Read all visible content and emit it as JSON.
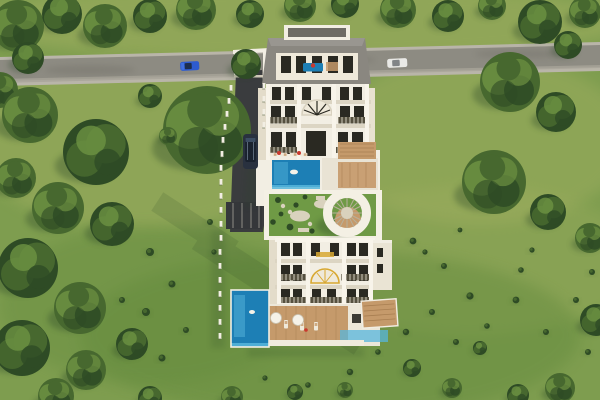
{
  "meta": {
    "title": "Aerial 3D render of twin luxury villa blocks on a green hillside",
    "view": "top-down drone perspective",
    "text_on_screen": "none"
  },
  "palette": {
    "grass_base": "#7e9d4f",
    "grass_light": "#a7b264",
    "grass_dark": "#648a3c",
    "tree_dark": "#2e4b25",
    "tree_mid": "#47682f",
    "tree_light": "#6d9242",
    "shadow": "#2b4726",
    "road": "#8d8b82",
    "road_edge": "#b9b5a9",
    "driveway": "#3a3c3e",
    "white": "#f2eee3",
    "trim": "#dcd5c3",
    "cream": "#efe9da",
    "roof": "#8a8780",
    "roof_dark": "#6e6b65",
    "window": "#2a2922",
    "railing": "#55503f",
    "pool": "#1d7fb5",
    "pool_light": "#57b6dc",
    "wood": "#c59a6b",
    "wood_dark": "#9c7347",
    "garden": "#6f9a45",
    "gazebo": "#f4f0e4",
    "gold": "#d8a832",
    "car_blue": "#2d5bd0",
    "car_white": "#e9e9e6",
    "car_dark": "#29313f",
    "red": "#c9392e"
  },
  "objects": {
    "road_label": "asphalt road with curbs",
    "upper_villa_label": "upper villa with roof terrace and infinity pool",
    "lower_villa_label": "lower villa with roof garden, round gazebo and pool",
    "gate_label": "white entrance gate over driveway",
    "driveway_label": "dark asphalt driveway",
    "blue_car_label": "blue car on road",
    "white_car_label": "white car on road",
    "suv_label": "dark SUV on driveway"
  },
  "scene": {
    "trees": [
      {
        "x": 18,
        "y": 26,
        "r": 26,
        "v": "a"
      },
      {
        "x": 62,
        "y": 14,
        "r": 20,
        "v": "b"
      },
      {
        "x": 105,
        "y": 26,
        "r": 22,
        "v": "a"
      },
      {
        "x": 150,
        "y": 16,
        "r": 17,
        "v": "b"
      },
      {
        "x": 196,
        "y": 10,
        "r": 20,
        "v": "a"
      },
      {
        "x": 28,
        "y": 58,
        "r": 16,
        "v": "b"
      },
      {
        "x": 0,
        "y": 90,
        "r": 18,
        "v": "a"
      },
      {
        "x": 250,
        "y": 14,
        "r": 14,
        "v": "b"
      },
      {
        "x": 300,
        "y": 6,
        "r": 16,
        "v": "a"
      },
      {
        "x": 345,
        "y": 4,
        "r": 14,
        "v": "b"
      },
      {
        "x": 398,
        "y": 10,
        "r": 18,
        "v": "a"
      },
      {
        "x": 448,
        "y": 16,
        "r": 16,
        "v": "b"
      },
      {
        "x": 492,
        "y": 6,
        "r": 14,
        "v": "a"
      },
      {
        "x": 540,
        "y": 22,
        "r": 22,
        "v": "b"
      },
      {
        "x": 585,
        "y": 12,
        "r": 16,
        "v": "a"
      },
      {
        "x": 568,
        "y": 45,
        "r": 14,
        "v": "b"
      },
      {
        "x": 510,
        "y": 82,
        "r": 30,
        "v": "a"
      },
      {
        "x": 556,
        "y": 112,
        "r": 20,
        "v": "b"
      },
      {
        "x": 494,
        "y": 182,
        "r": 32,
        "v": "a"
      },
      {
        "x": 548,
        "y": 212,
        "r": 18,
        "v": "b"
      },
      {
        "x": 590,
        "y": 238,
        "r": 15,
        "v": "a"
      },
      {
        "x": 596,
        "y": 320,
        "r": 16,
        "v": "b"
      },
      {
        "x": 560,
        "y": 388,
        "r": 15,
        "v": "a"
      },
      {
        "x": 518,
        "y": 395,
        "r": 11,
        "v": "b"
      },
      {
        "x": 30,
        "y": 115,
        "r": 28,
        "v": "a"
      },
      {
        "x": 96,
        "y": 152,
        "r": 33,
        "v": "b"
      },
      {
        "x": 58,
        "y": 208,
        "r": 26,
        "v": "a"
      },
      {
        "x": 112,
        "y": 224,
        "r": 22,
        "v": "b"
      },
      {
        "x": 16,
        "y": 178,
        "r": 20,
        "v": "a"
      },
      {
        "x": 207,
        "y": 130,
        "r": 44,
        "v": "a"
      },
      {
        "x": 150,
        "y": 96,
        "r": 12,
        "v": "b"
      },
      {
        "x": 246,
        "y": 64,
        "r": 15,
        "v": "b"
      },
      {
        "x": 168,
        "y": 136,
        "r": 9,
        "v": "a"
      },
      {
        "x": 28,
        "y": 268,
        "r": 30,
        "v": "b"
      },
      {
        "x": 80,
        "y": 308,
        "r": 26,
        "v": "a"
      },
      {
        "x": 22,
        "y": 348,
        "r": 28,
        "v": "b"
      },
      {
        "x": 86,
        "y": 370,
        "r": 20,
        "v": "a"
      },
      {
        "x": 132,
        "y": 344,
        "r": 16,
        "v": "b"
      },
      {
        "x": 56,
        "y": 396,
        "r": 18,
        "v": "a"
      },
      {
        "x": 150,
        "y": 398,
        "r": 12,
        "v": "b"
      },
      {
        "x": 232,
        "y": 397,
        "r": 11,
        "v": "a"
      },
      {
        "x": 295,
        "y": 392,
        "r": 8,
        "v": "b"
      },
      {
        "x": 345,
        "y": 390,
        "r": 8,
        "v": "a"
      },
      {
        "x": 412,
        "y": 368,
        "r": 9,
        "v": "b"
      },
      {
        "x": 452,
        "y": 388,
        "r": 10,
        "v": "a"
      },
      {
        "x": 480,
        "y": 348,
        "r": 7,
        "v": "b"
      }
    ],
    "bushes": [
      {
        "x": 150,
        "y": 252,
        "r": 4
      },
      {
        "x": 172,
        "y": 284,
        "r": 3.5
      },
      {
        "x": 146,
        "y": 312,
        "r": 4
      },
      {
        "x": 186,
        "y": 330,
        "r": 3
      },
      {
        "x": 162,
        "y": 358,
        "r": 3.5
      },
      {
        "x": 122,
        "y": 300,
        "r": 3
      },
      {
        "x": 210,
        "y": 222,
        "r": 3
      },
      {
        "x": 214,
        "y": 252,
        "r": 2.6
      },
      {
        "x": 413,
        "y": 241,
        "r": 3.4
      },
      {
        "x": 444,
        "y": 266,
        "r": 3
      },
      {
        "x": 470,
        "y": 296,
        "r": 3.6
      },
      {
        "x": 432,
        "y": 312,
        "r": 3
      },
      {
        "x": 406,
        "y": 332,
        "r": 3.2
      },
      {
        "x": 456,
        "y": 342,
        "r": 3
      },
      {
        "x": 487,
        "y": 326,
        "r": 2.8
      },
      {
        "x": 516,
        "y": 300,
        "r": 3.4
      },
      {
        "x": 546,
        "y": 332,
        "r": 3
      },
      {
        "x": 576,
        "y": 300,
        "r": 3
      },
      {
        "x": 521,
        "y": 270,
        "r": 2.8
      },
      {
        "x": 592,
        "y": 272,
        "r": 3
      },
      {
        "x": 350,
        "y": 372,
        "r": 3.2
      },
      {
        "x": 378,
        "y": 352,
        "r": 2.8
      },
      {
        "x": 308,
        "y": 385,
        "r": 2.8
      },
      {
        "x": 265,
        "y": 378,
        "r": 2.6
      },
      {
        "x": 425,
        "y": 252,
        "r": 2.6
      },
      {
        "x": 588,
        "y": 352,
        "r": 3
      },
      {
        "x": 532,
        "y": 250,
        "r": 2.6
      },
      {
        "x": 460,
        "y": 230,
        "r": 2.4
      }
    ],
    "fence_posts": [
      [
        231,
        88
      ],
      [
        229,
        101
      ],
      [
        227,
        114
      ],
      [
        225,
        127
      ],
      [
        223,
        140
      ],
      [
        222,
        154
      ],
      [
        221,
        168
      ],
      [
        221,
        182
      ],
      [
        221,
        196
      ],
      [
        221,
        210
      ],
      [
        221,
        224
      ],
      [
        221,
        238
      ],
      [
        220,
        252
      ],
      [
        220,
        266
      ],
      [
        220,
        280
      ],
      [
        220,
        294
      ],
      [
        220,
        308
      ],
      [
        220,
        322
      ],
      [
        220,
        336
      ],
      [
        264,
        86
      ],
      [
        264,
        99
      ],
      [
        264,
        112
      ],
      [
        264,
        125
      ]
    ]
  }
}
